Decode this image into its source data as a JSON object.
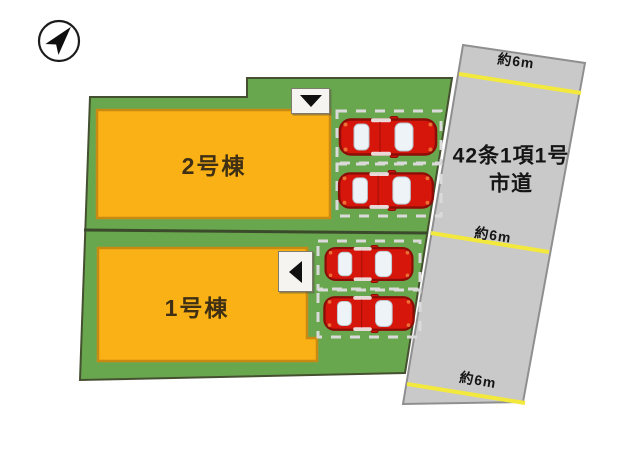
{
  "site_plan": {
    "compass": {
      "icon": "north-arrow",
      "direction": "north-east"
    },
    "lots": [
      {
        "building_label": "2号棟",
        "entrance_arrow": "down",
        "parking_spaces": 2
      },
      {
        "building_label": "1号棟",
        "entrance_arrow": "left",
        "parking_spaces": 2
      }
    ],
    "road": {
      "name_line1": "42条1項1号",
      "name_line2": "市道",
      "width_labels": [
        "約6m",
        "約6m",
        "約6m"
      ]
    },
    "colors": {
      "lot_green": "#69a74e",
      "lot_border": "#44502f",
      "building_orange": "#f9b115",
      "building_border": "#c98a12",
      "road_gray": "#c9c9c9",
      "road_border": "#8f8f8f",
      "lane_line_yellow": "#f3e93c",
      "car_red": "#d6150b",
      "stall_line": "#dadada"
    }
  }
}
